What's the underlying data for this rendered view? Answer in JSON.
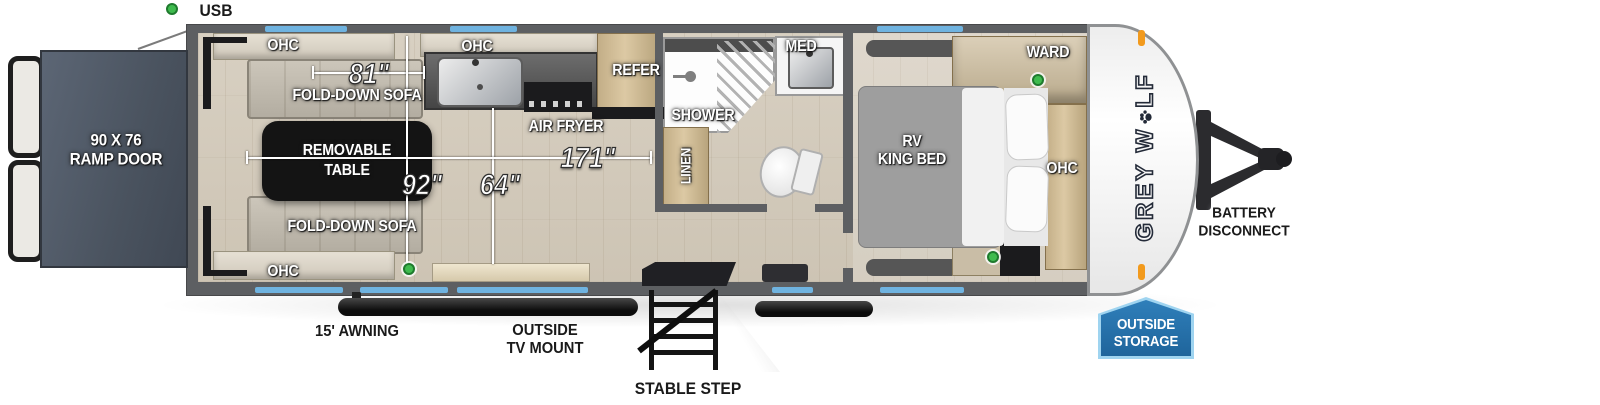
{
  "legend": {
    "usb": "USB"
  },
  "exterior": {
    "ramp_door": {
      "line1": "90 X 76",
      "line2": "RAMP DOOR"
    },
    "awning": "15' AWNING",
    "tv_mount": {
      "line1": "OUTSIDE",
      "line2": "TV MOUNT"
    },
    "stable_step": "STABLE STEP",
    "battery": {
      "line1": "BATTERY",
      "line2": "DISCONNECT"
    },
    "storage": {
      "line1": "OUTSIDE",
      "line2": "STORAGE"
    },
    "brand": {
      "pre": "GREY W",
      "post": "LF"
    }
  },
  "garage": {
    "ohc_top": "OHC",
    "ohc_bottom": "OHC",
    "sofa_top": "FOLD-DOWN SOFA",
    "sofa_bottom": "FOLD-DOWN SOFA",
    "table": {
      "line1": "REMOVABLE",
      "line2": "TABLE"
    }
  },
  "kitchen": {
    "ohc": "OHC",
    "air_fryer": "AIR FRYER",
    "refer": "REFER"
  },
  "bath": {
    "shower": "SHOWER",
    "med": "MED",
    "linen": "LINEN"
  },
  "bedroom": {
    "ward": "WARD",
    "ohc": "OHC",
    "bed": {
      "line1": "RV",
      "line2": "KING BED"
    }
  },
  "dimensions": {
    "sofa_length": "81\"",
    "interior_width": "92\"",
    "opening": "64\"",
    "garage_length": "171\""
  },
  "colors": {
    "window_blue": "#6fb3e0",
    "usb_green": "#3fbb4e",
    "badge_blue": "#2f7fba",
    "badge_blue_dark": "#1f659c",
    "wall": "#5d5f62",
    "floor": "#d2c9ba",
    "ramp": "#515b69",
    "table_black": "#141414"
  }
}
